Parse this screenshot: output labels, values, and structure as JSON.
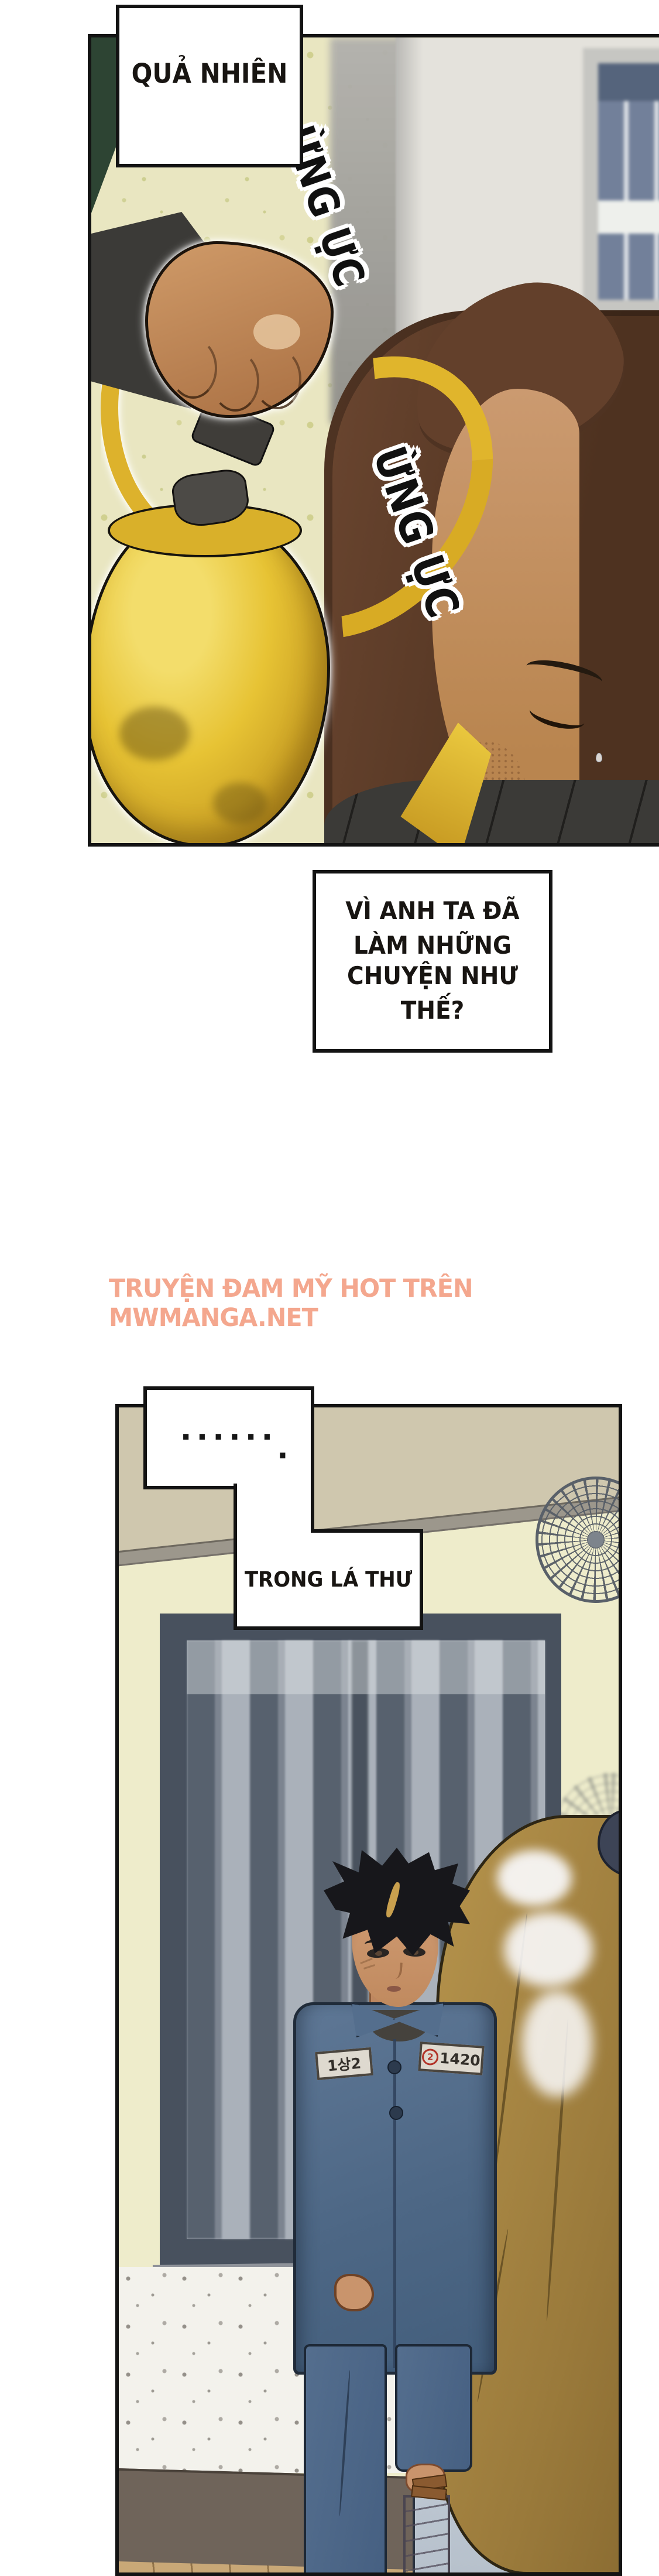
{
  "page_type": "manga-page",
  "panel_top": {
    "caption": "QUẢ NHIÊN",
    "sfx_left": "ỪNG ỰC",
    "sfx_right": "ỪNG ỰC",
    "sign_number": "3"
  },
  "caption_box": {
    "line1": "VÌ ANH TA ĐÃ LÀM NHỮNG",
    "line2": "CHUYỆN NHƯ THẾ?"
  },
  "watermark": {
    "text": "TRUYỆN ĐAM MỸ HOT TRÊN MWMANGA.NET",
    "color": "#f4a78e"
  },
  "panel_bottom": {
    "ellipsis": "......",
    "ellipsis_tail": ".",
    "caption": "TRONG LÁ THƯ",
    "uniform_badge_left": "1상2",
    "uniform_badge_right_circled": "2",
    "uniform_badge_right": "1420"
  },
  "colors": {
    "panel_border": "#131313",
    "watermark": "#f4a78e",
    "kettle_yellow": "#e7c334",
    "uniform_blue": "#5a7391",
    "wall_cream": "#e9e6c1",
    "wall_speckled": "#eeeccb",
    "sign_red": "#c23b30"
  }
}
